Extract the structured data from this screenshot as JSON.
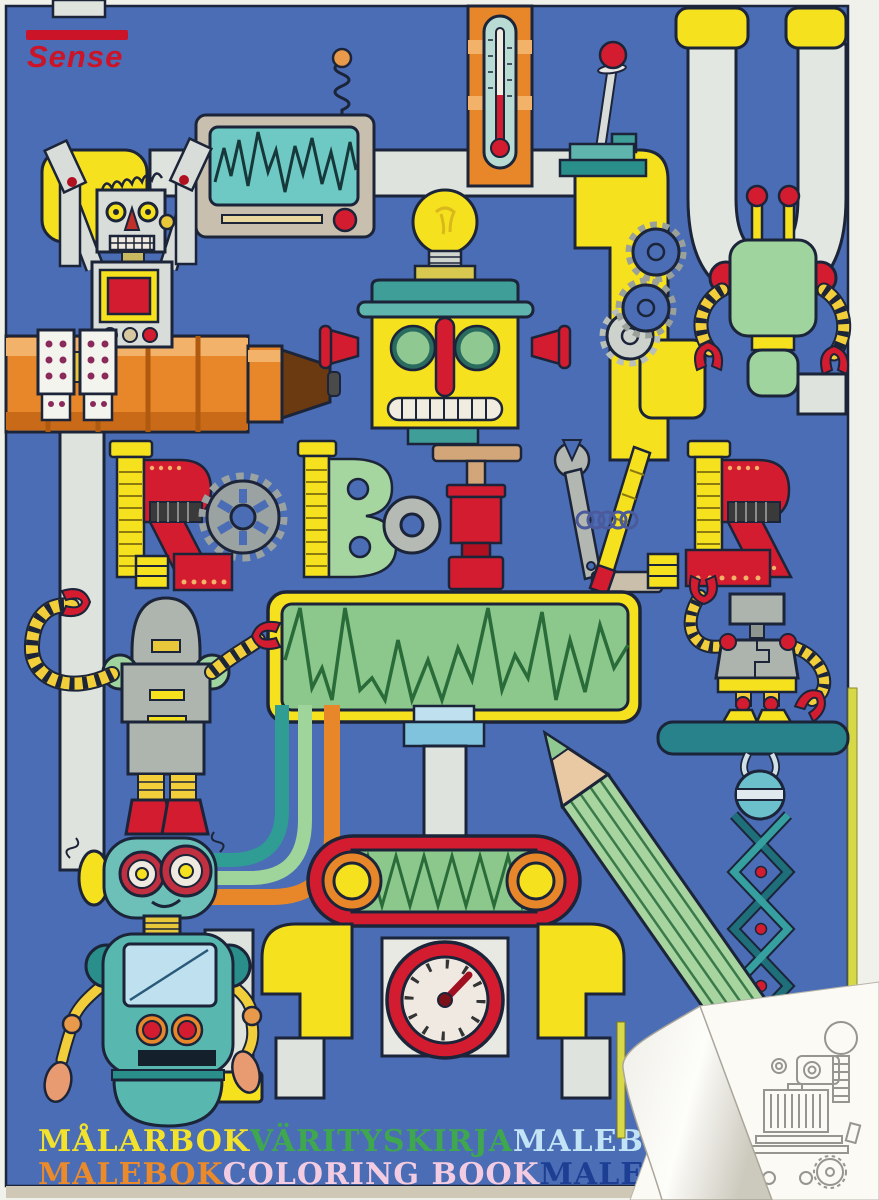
{
  "brand": {
    "name": "Sense",
    "color": "#cc1428"
  },
  "title": {
    "text": "ROBOTAR",
    "letters": [
      {
        "char": "R",
        "made_of": "red riveted panel with yellow bolt"
      },
      {
        "char": "O",
        "made_of": "grey gear wheel"
      },
      {
        "char": "B",
        "made_of": "green panel with yellow bolt"
      },
      {
        "char": "O",
        "made_of": "metal washer"
      },
      {
        "char": "T",
        "made_of": "clamp press"
      },
      {
        "char": "A",
        "made_of": "wrench, yellow rod and spring"
      },
      {
        "char": "R",
        "made_of": "red riveted panel with yellow bolt"
      }
    ]
  },
  "footer": {
    "line1": [
      {
        "text": "MÅLARBOK",
        "color": "#f2e22c"
      },
      {
        "text": "VÄRITYSKIRJA",
        "color": "#3fa84e"
      },
      {
        "text": "MALEBOG",
        "color": "#c2e4f6"
      }
    ],
    "line2": [
      {
        "text": "MALEBOK",
        "color": "#ea8a2a"
      },
      {
        "text": "COLORING BOOK",
        "color": "#f4cce2"
      },
      {
        "text": "MALERBUCH",
        "color": "#1c3f94"
      }
    ]
  },
  "palette": {
    "cover_blue": "#4a6db5",
    "outline": "#1b2438",
    "yellow": "#f6e11e",
    "red": "#d41c30",
    "teal": "#3f9f98",
    "pipe_grey": "#dfe3dd",
    "orange": "#e8872a",
    "light_green": "#9fd49f"
  },
  "scene": {
    "description": "Coloring book cover: cartoon robots and machine parts joined by pipes on a blue background; bottom-right corner of the cover curls up revealing a black-and-white robot coloring page",
    "elements": [
      "sense-logo",
      "waveform-monitor",
      "spring-antenna",
      "thermometer",
      "control-lever",
      "u-pipe",
      "hanging-green-robot",
      "gear-cluster",
      "grey-robot-on-telescope",
      "light-bulb-robot-head",
      "title-robotar",
      "waveform-display",
      "small-grey-robot",
      "colored-cables",
      "conveyor-roller",
      "pressure-gauge",
      "teal-robot",
      "green-pencil",
      "scissor-lift-robot",
      "page-curl-coloring-page"
    ]
  }
}
